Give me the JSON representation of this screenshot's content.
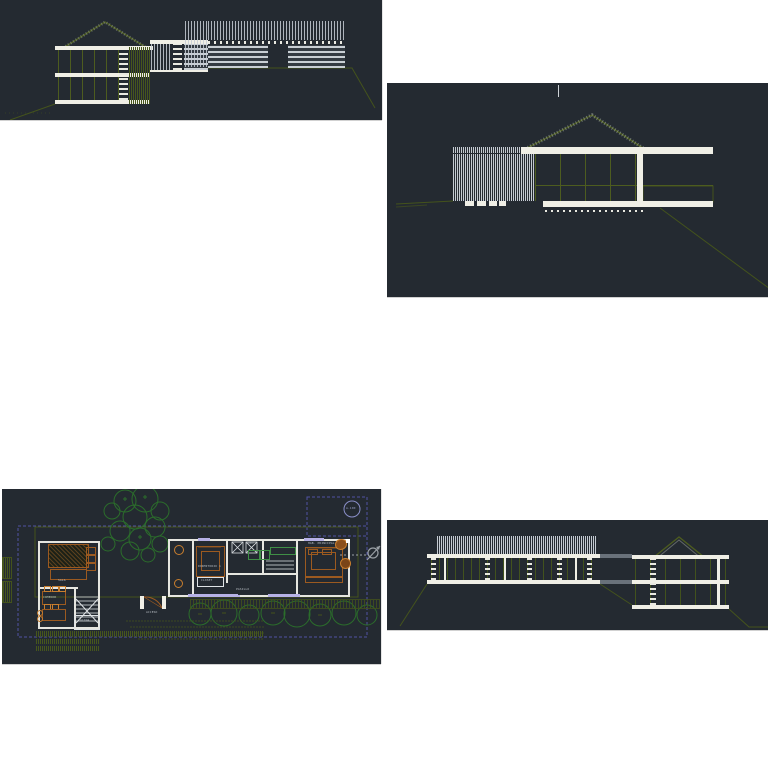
{
  "document": {
    "kind": "cad-drawing-sheet-set",
    "background": "#ffffff"
  },
  "colors": {
    "panel_background": "#242a31",
    "line_white": "#f0efe6",
    "line_gray": "#c3c9ce",
    "line_olive": "#4d5c1f",
    "tree_green": "#2b6d2b",
    "fixture_green": "#3f8f46",
    "furniture_orange": "#9c5a20",
    "furniture_orange_light": "#c87e2e",
    "wall_lavender": "#b6b1e6",
    "boundary_purple": "#5152a3",
    "label_gray": "#b4bac0",
    "connector_gray": "#69717a"
  },
  "plan": {
    "sheet_bubble": "A-100",
    "rooms": {
      "sala": "SALA",
      "comedor": "COMEDOR",
      "cocina": "COCINA",
      "acceso": "ACCESO",
      "dormitorio1": "DORMITORIO 1",
      "closet": "CLOSET",
      "bano": "BAÑO",
      "pasillo": "PASILLO",
      "hab_principal": "HAB. PRINCIPAL"
    }
  }
}
